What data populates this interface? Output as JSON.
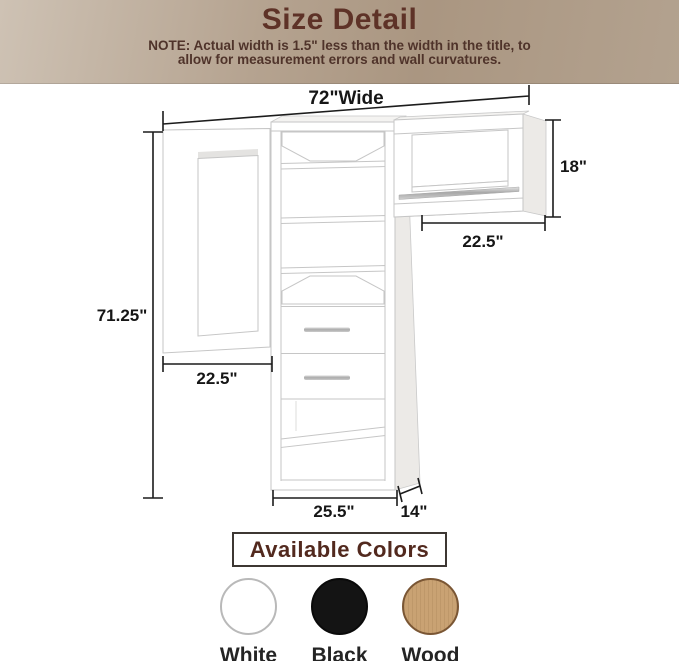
{
  "header": {
    "title": "Size Detail",
    "note_line1": "NOTE: Actual width is 1.5\" less than the width in the title, to",
    "note_line2": "allow for measurement errors and wall curvatures."
  },
  "diagram": {
    "description": "L-shaped closet organizer line drawing: left open hanging frame, center storage tower with shelves, two drawers and slanted shoe shelf, right hanging cabinet with shelf and clothes rod",
    "dimensions": {
      "total_width": "72\"Wide",
      "total_height": "71.25\"",
      "left_section_width": "22.5\"",
      "right_section_height": "18\"",
      "right_section_width": "22.5\"",
      "tower_width": "25.5\"",
      "tower_depth": "14\""
    }
  },
  "colors_section": {
    "title": "Available Colors",
    "swatches": [
      {
        "label": "White",
        "hex": "#ffffff"
      },
      {
        "label": "Black",
        "hex": "#141414"
      },
      {
        "label": "Wood",
        "hex": "#c9a273"
      }
    ]
  },
  "theme": {
    "banner_gradient_left": "#cec2b4",
    "banner_gradient_right": "#ac9884",
    "heading_text": "#5e3227",
    "note_text": "#4f332a",
    "colors_box_title": "#52291e",
    "dimension_text": "#161616",
    "furniture_outline": "#c6c6c6"
  }
}
